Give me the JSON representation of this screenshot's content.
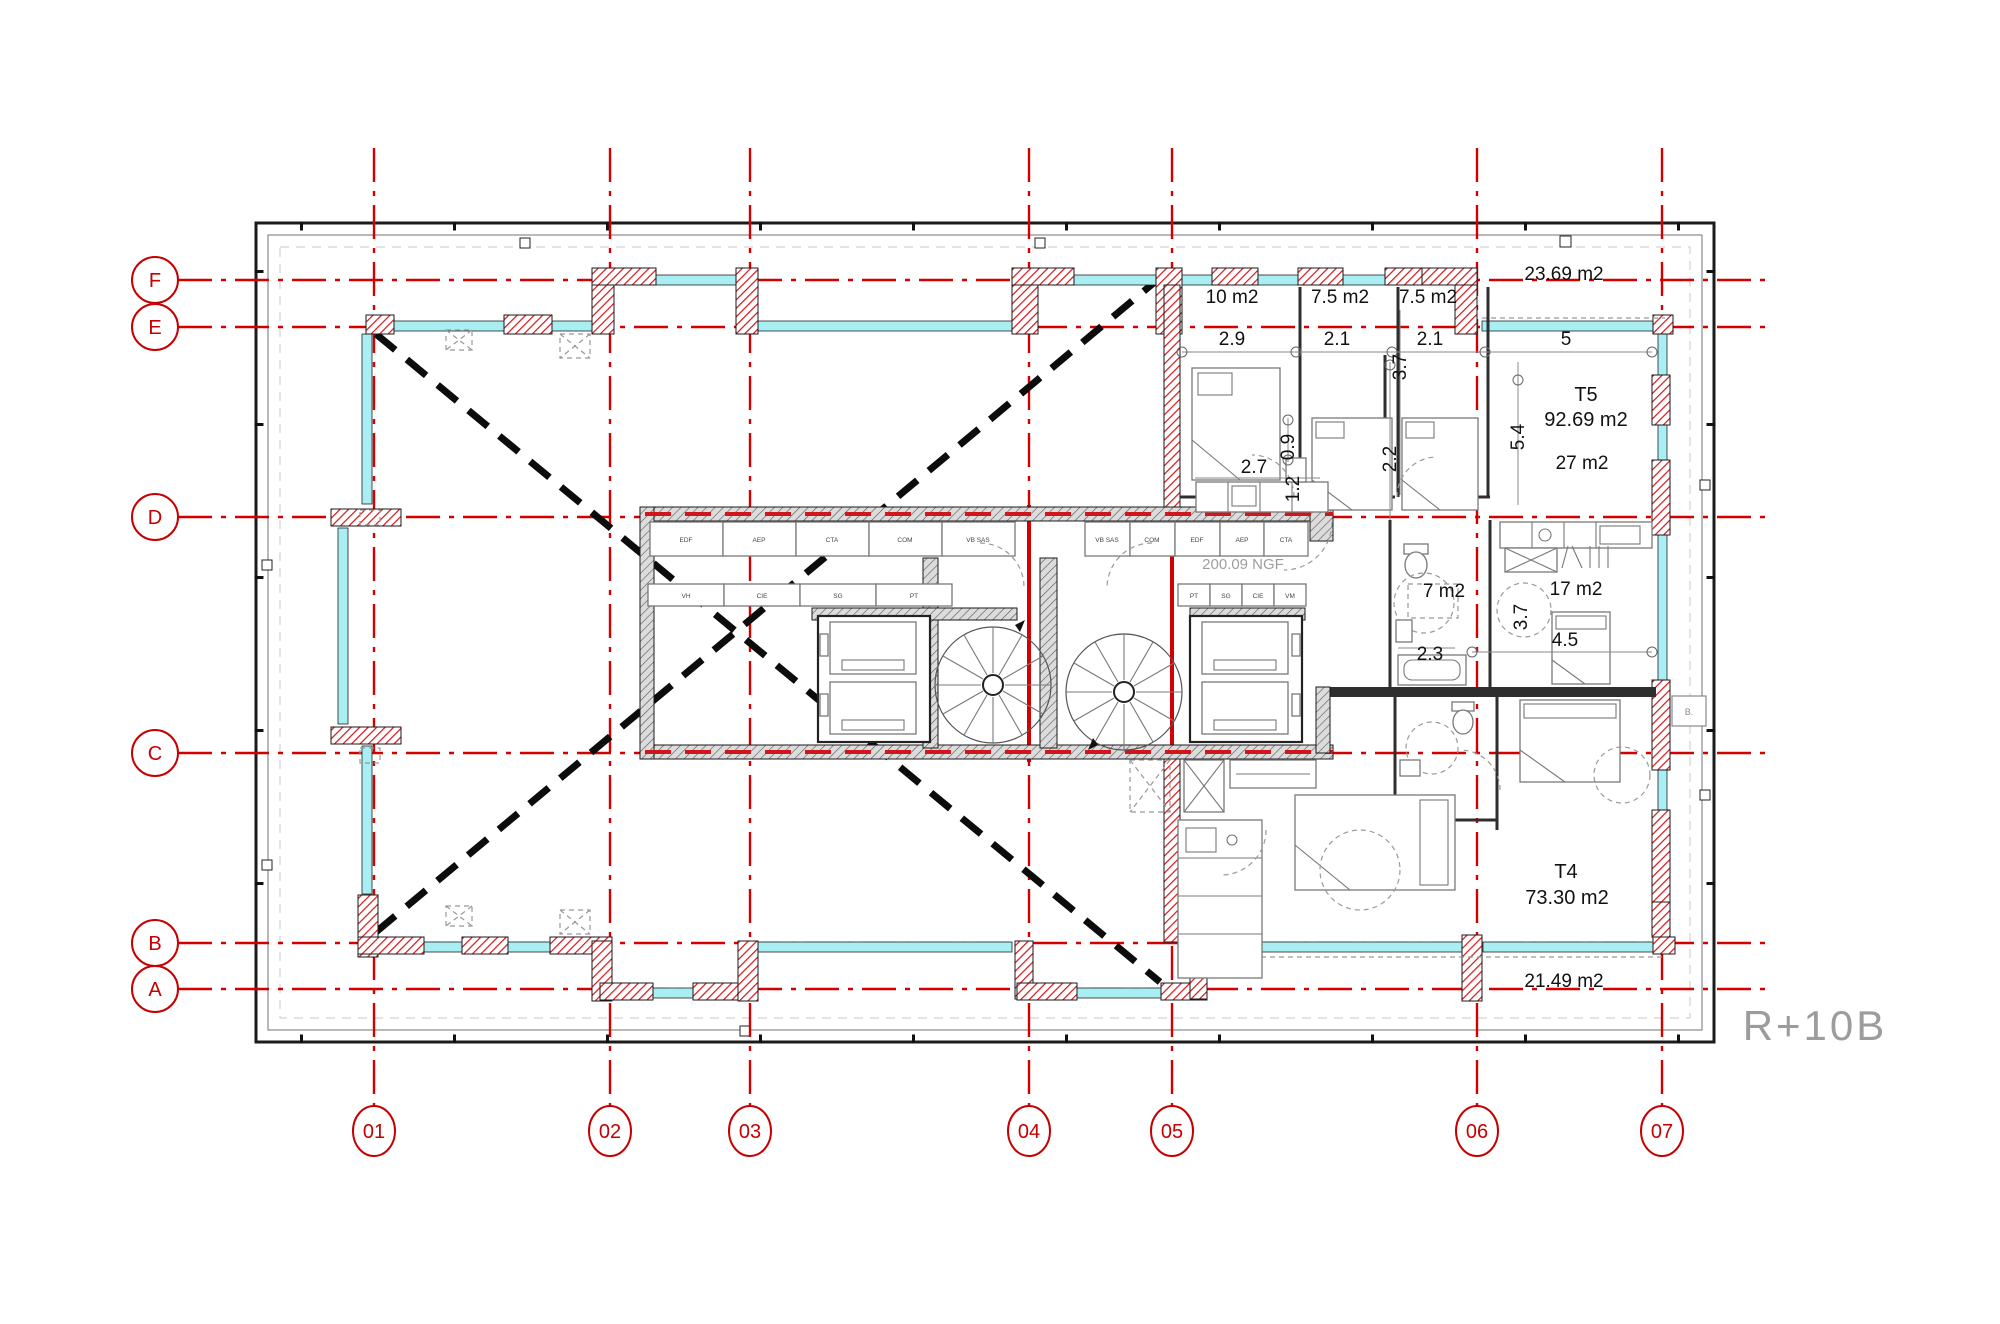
{
  "drawing": {
    "floor_label": "R+10B",
    "level_note": "200.09 NGF"
  },
  "grid": {
    "color": "#d40000",
    "cols": [
      {
        "label": "01"
      },
      {
        "label": "02"
      },
      {
        "label": "03"
      },
      {
        "label": "04"
      },
      {
        "label": "05"
      },
      {
        "label": "06"
      },
      {
        "label": "07"
      }
    ],
    "rows": [
      {
        "label": "F"
      },
      {
        "label": "E"
      },
      {
        "label": "D"
      },
      {
        "label": "C"
      },
      {
        "label": "B"
      },
      {
        "label": "A"
      }
    ]
  },
  "units": {
    "t5": {
      "name": "T5",
      "area": "92.69 m2"
    },
    "t4": {
      "name": "T4",
      "area": "73.30 m2"
    }
  },
  "rooms": {
    "bedroom_1": "10 m2",
    "bedroom_2": "7.5 m2",
    "bedroom_3": "7.5 m2",
    "terrace_north": "23.69 m2",
    "living": "27 m2",
    "bathroom": "7 m2",
    "bedroom_4": "17 m2",
    "terrace_south": "21.49 m2"
  },
  "dimensions": {
    "bedroom_1_w": "2.9",
    "bedroom_2_w": "2.1",
    "bedroom_3_h": "3.7",
    "bedroom_3_w": "2.1",
    "living_w": "5",
    "living_h": "5.4",
    "kitchen_w": "2.7",
    "entry_h": "0.9",
    "closet_h": "1.2",
    "hall_h": "2.2",
    "bedroom_4_d": "3.7",
    "bedroom_4_w": "4.5",
    "bathroom_w": "2.3"
  },
  "core": {
    "ducts_row1_left": [
      "EDF",
      "AEP",
      "CTA",
      "COM",
      "VB SAS"
    ],
    "ducts_row1_right": [
      "VB SAS",
      "COM",
      "EDF",
      "AEP",
      "CTA"
    ],
    "ducts_row2_left": [
      "VH",
      "CIE",
      "SG",
      "PT"
    ],
    "ducts_row2_right": [
      "PT",
      "SG",
      "CIE",
      "VM"
    ],
    "shaft_label": "B."
  },
  "colors": {
    "grid_red": "#d40000",
    "pier_red": "#d0161b",
    "glazing_cyan": "#a9eef3",
    "wall_gray": "#dedede",
    "line_dark": "#222222",
    "muted_gray": "#9e9e9e",
    "diag_black": "#0c0c0c"
  }
}
